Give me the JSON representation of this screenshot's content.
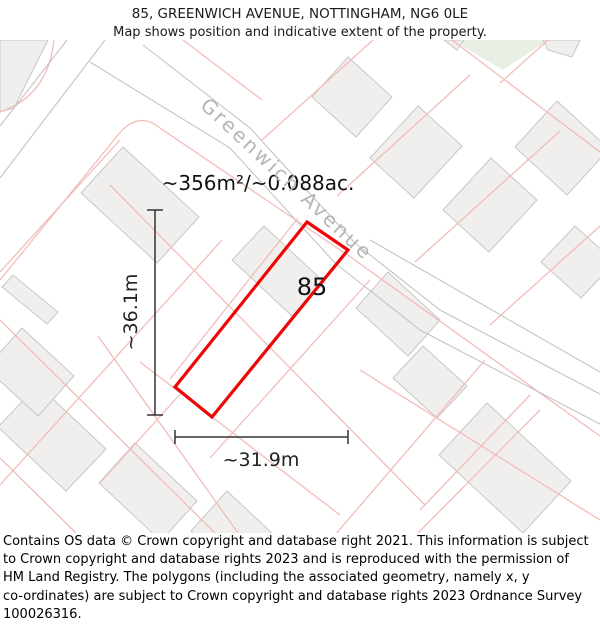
{
  "header": {
    "title": "85, GREENWICH AVENUE, NOTTINGHAM, NG6 0LE",
    "subtitle": "Map shows position and indicative extent of the property."
  },
  "map": {
    "area_label": "~356m²/~0.088ac.",
    "plot_number": "85",
    "street_label": "Greenwich Avenue",
    "dim_vertical_label": "~36.1m",
    "dim_horizontal_label": "~31.9m",
    "colors": {
      "red": "#ee0505",
      "pink": "#f2bcb8",
      "road": "#c4c4c4",
      "building_fill": "#f0efee",
      "building_stroke": "#c9c7c6",
      "dim": "#333333",
      "green": "#e8f0e4"
    },
    "geometry": {
      "green_patch": "452,0 548,0 503,30",
      "buildings": [
        "0,0 48,0 14,68 0,72",
        "392,57 356,97 312,57 348,17",
        "462,106 414,158 370,118 418,66",
        "537,160 489,212 443,170 491,118",
        "609,109 567,155 515,107 557,61",
        "615,222 581,258 541,222 575,186",
        "199,177 157,223 81,153 123,107",
        "324,242 292,276 232,220 264,186",
        "440,280 408,316 356,268 388,232",
        "467,346 437,378 393,338 423,306",
        "571,441 523,493 439,415 487,363",
        "106,409 66,451 -2,387 38,345",
        "197,461 161,501 99,443 135,403",
        "289,509 253,549 191,491 227,451",
        "58,272 47,284 2,247 13,235",
        "74,336 38,376 -14,328 22,288",
        "543,0 580,0 572,17 548,10",
        "444,0 464,0 457,10"
      ],
      "parcel_lines": [
        "M 0,240 L 118,95 Q 138,70 160,88 L 352,218 L 600,396",
        "M 110,145 L 425,465",
        "M 0,280 L 215,493",
        "M 0,418 L 76,493",
        "M 120,100 L 0,232",
        "M 222,200 L 0,445",
        "M 370,240 L 210,418",
        "M 485,320 L 335,495",
        "M 540,370 L 418,493",
        "M 262,100 L 373,0",
        "M 337,156 L 470,35",
        "M 415,222 L 560,91",
        "M 490,285 L 600,186",
        "M 548,0 L 500,43",
        "M 452,0 L 600,112",
        "M 0,72 Q 48,56 54,0",
        "M 98,296 L 238,493",
        "M 360,330 L 600,480",
        "M 530,355 L 420,470",
        "M 183,0 L 262,60",
        "M 182,352 L 100,443",
        "M 140,322 L 340,475",
        "M 298,178 L 170,339"
      ],
      "road_lines": [
        "M 67,0 L 0,86",
        "M 105,0 L 0,138",
        "M 143,5 L 250,88 L 355,203 L 440,270 L 600,354",
        "M 90,22 L 230,108 L 335,223 L 420,290 L 600,384",
        "M 370,200 L 600,332"
      ],
      "red_outline": "307,182 348,210 212,377 175,347",
      "dim_v": {
        "x": 155,
        "y1": 170,
        "y2": 375,
        "cap": 8
      },
      "dim_h": {
        "y": 397,
        "x1": 175,
        "x2": 348,
        "cap": 7
      },
      "label_pos": {
        "area": {
          "x": 258,
          "y": 143
        },
        "plot": {
          "x": 312,
          "y": 247
        },
        "street": {
          "x": 287,
          "y": 139
        },
        "dim_v": {
          "x": 131,
          "y": 272
        },
        "dim_h": {
          "x": 261,
          "y": 420
        }
      }
    }
  },
  "footer": {
    "lines": [
      "Contains OS data © Crown copyright and database right 2021. This information is subject",
      "to Crown copyright and database rights 2023 and is reproduced with the permission of",
      "HM Land Registry. The polygons (including the associated geometry, namely x, y",
      "co-ordinates) are subject to Crown copyright and database rights 2023 Ordnance Survey",
      "100026316."
    ]
  }
}
